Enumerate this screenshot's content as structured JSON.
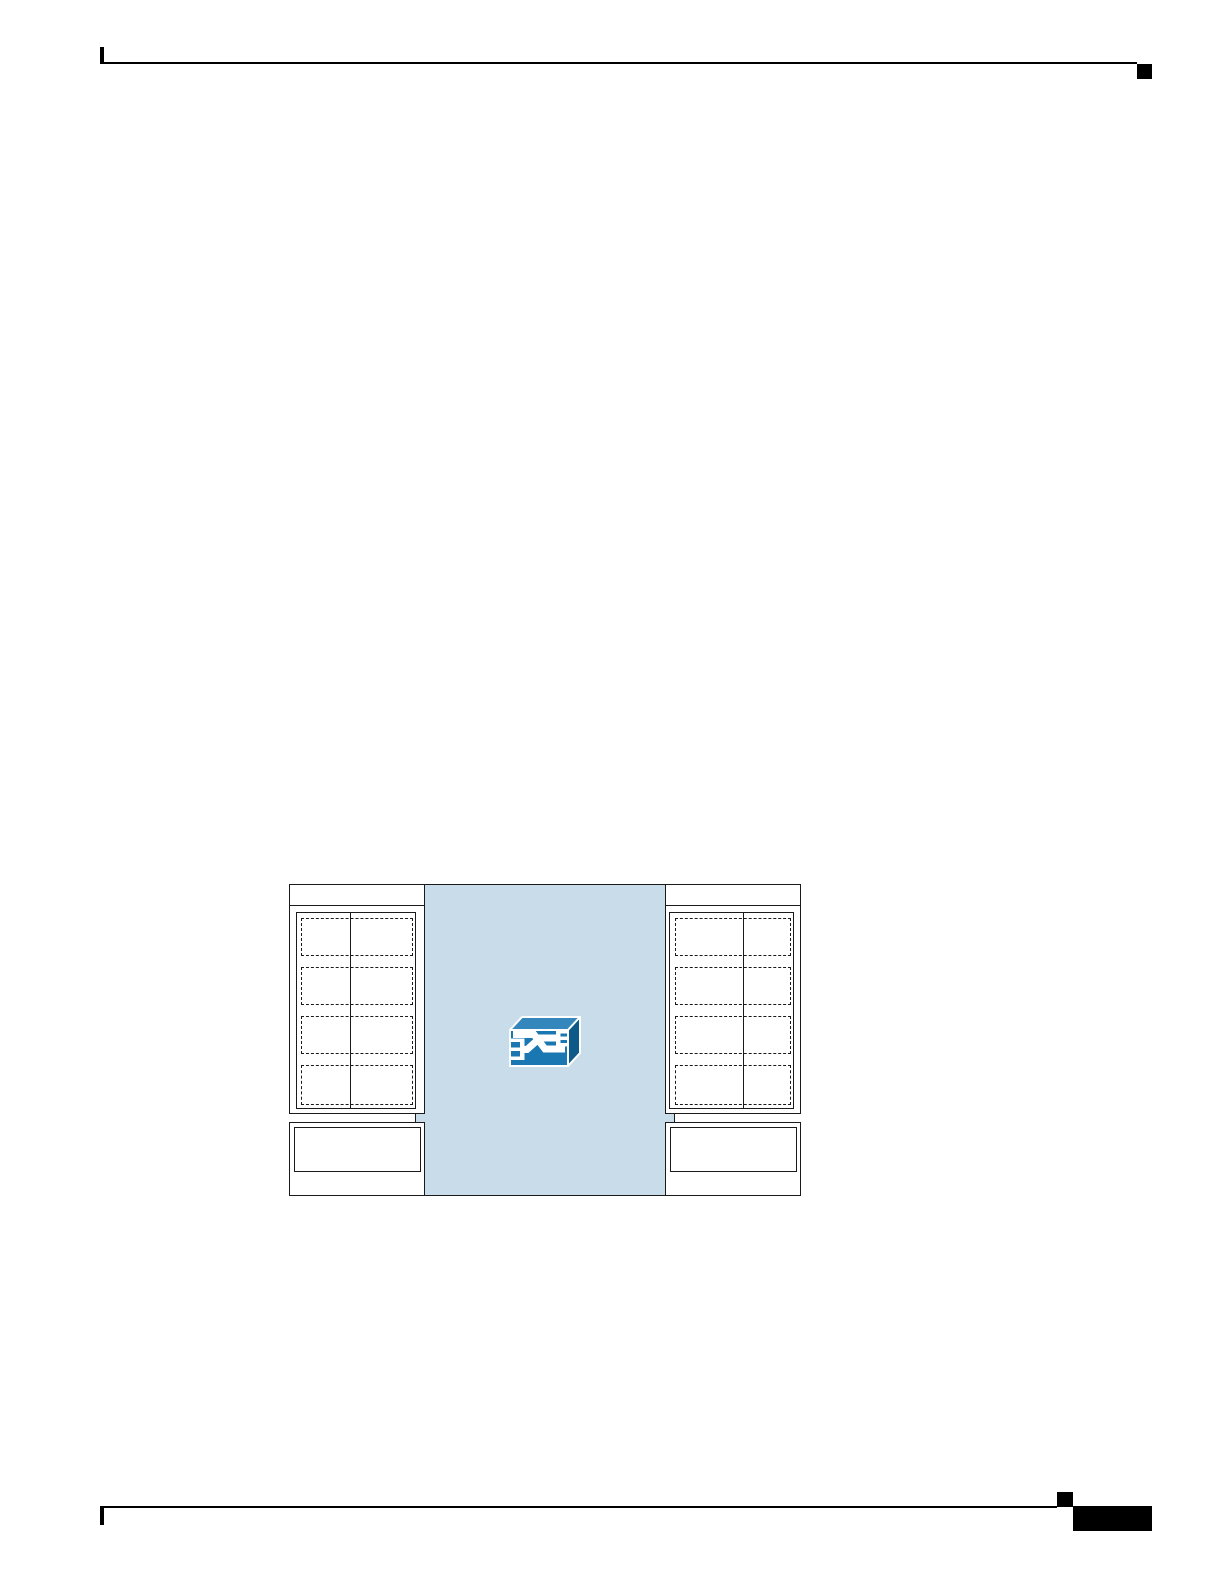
{
  "page": {
    "background": "#ffffff",
    "ink": "#000000",
    "header": {
      "rule": "horizontal-rule",
      "corner_block": "solid-square"
    },
    "footer": {
      "rule": "horizontal-rule",
      "corner_square": "solid-square",
      "page_number_block": "solid-black-block"
    }
  },
  "figure": {
    "type": "network-topology-diagram",
    "fabric": {
      "fill": "#c9dcea",
      "name": "switch-fabric-region"
    },
    "line_color": "#1a1a1a",
    "panel_fill": "#ffffff",
    "racks": [
      {
        "side": "left",
        "slot_rows": 4,
        "slot_columns": 2,
        "lower_shelf": true
      },
      {
        "side": "right",
        "slot_rows": 4,
        "slot_columns": 2,
        "lower_shelf": true
      }
    ],
    "switch_icon": {
      "name": "switch-icon",
      "front_fill": "#1a77b2",
      "top_fill": "#3387bd",
      "side_fill": "#0d5a88",
      "glyph_fill": "#ffffff",
      "outline": "#ffffff"
    }
  }
}
